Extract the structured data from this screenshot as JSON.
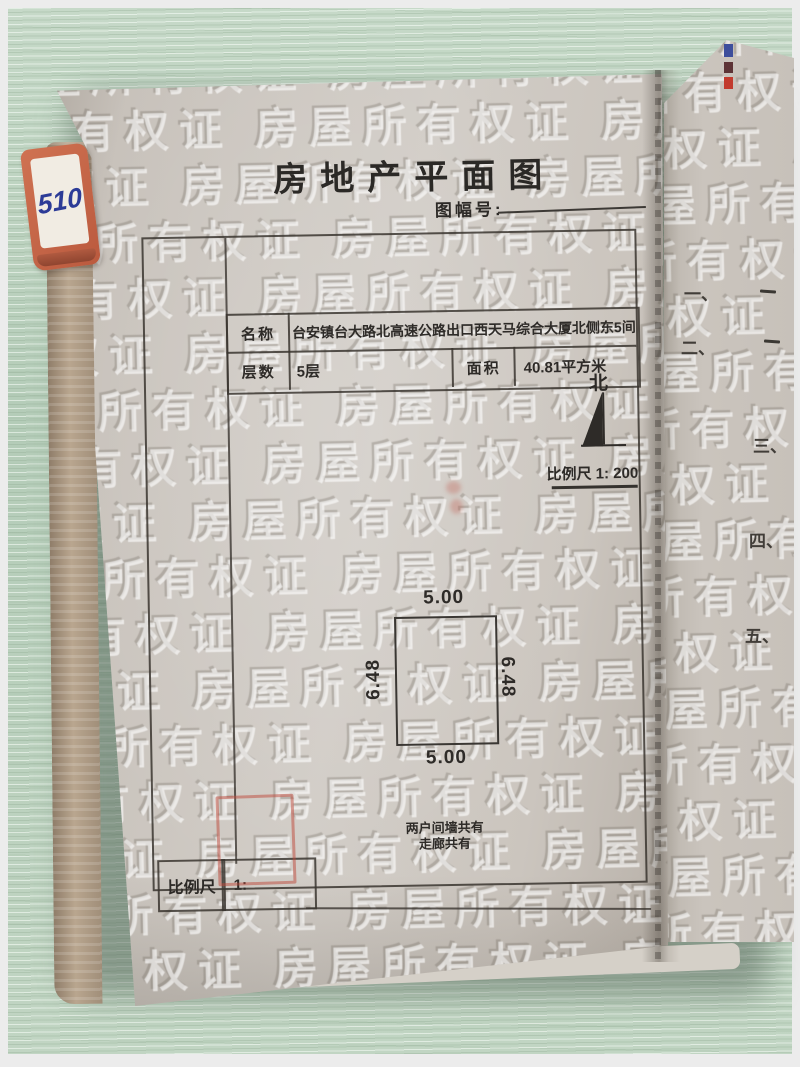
{
  "document": {
    "title": "房地产平面图",
    "sheet_no_label": "图幅号:",
    "info_table": {
      "name_label": "名称",
      "name_value": "台安镇台大路北高速公路出口西天马综合大厦北侧东5间",
      "floors_label": "层数",
      "floors_value": "5层",
      "area_label": "面积",
      "area_value": "40.81平方米"
    },
    "north_label": "北",
    "scale_note": "比例尺 1: 200",
    "floor_plan_dimensions": {
      "top": "5.00",
      "bottom": "5.00",
      "left": "6.48",
      "right": "6.48"
    },
    "notes": [
      "两户间墙共有",
      "走廊共有"
    ],
    "bottom_scale": {
      "label": "比例尺",
      "value": "1:"
    },
    "watermark_text": "房屋所有权证"
  },
  "index_tab": {
    "label": "510"
  },
  "next_page_items": [
    "一、",
    "二、",
    "三、",
    "四、",
    "五、"
  ],
  "colors": {
    "desk_green": "#b9cfbc",
    "page_gray": "#cbc6bf",
    "ink": "#2e2b28",
    "stamp_red": "#be483a",
    "tab_orange": "#c4664a",
    "tab_text_blue": "#2c3b97",
    "edge_mark_blue": "#3d4e9c",
    "edge_mark_maroon": "#5d3336",
    "edge_mark_red": "#c23b2e"
  }
}
